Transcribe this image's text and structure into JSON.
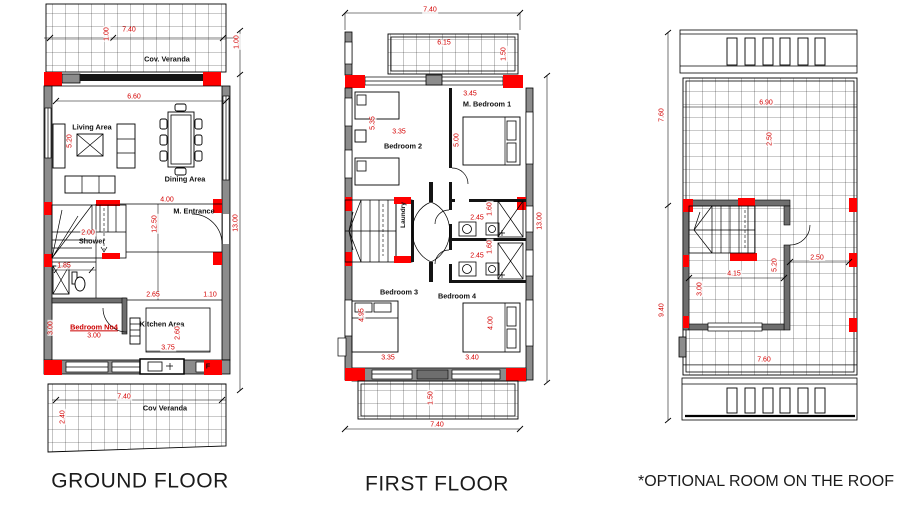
{
  "colors": {
    "wall_gray": "#8c8c8c",
    "column_red": "#ff0000",
    "dim_red": "#d40000",
    "line": "#000000"
  },
  "ground": {
    "title": "GROUND FLOOR",
    "labels": {
      "veranda_top": "Cov. Veranda",
      "veranda_bottom": "Cov Veranda",
      "living": "Living Area",
      "dining": "Dining Area",
      "entrance": "M. Entrance",
      "shower": "Shower",
      "bedroom4": "Bedroom No4",
      "kitchen": "Kitchen Area",
      "fridge": "F"
    },
    "dims": {
      "top_width": "7.40",
      "veranda_depth_a": "1.00",
      "veranda_depth_b": "1.00",
      "living_width": "6.60",
      "living_height": "5.20",
      "hall_width": "4.00",
      "inner_height": "12.50",
      "total_height": "13.00",
      "shower": "2.00",
      "wc": "1.85",
      "pass_a": "2.65",
      "pass_b": "1.10",
      "bed4_w": "3.00",
      "bed4_h": "3.00",
      "kitchen_w": "3.75",
      "kitchen_h": "2.60",
      "bottom_width": "7.40",
      "veranda_bottom_depth": "2.40"
    }
  },
  "first": {
    "title": "FIRST FLOOR",
    "labels": {
      "mbedroom1": "M. Bedroom 1",
      "bedroom2": "Bedroom 2",
      "bedroom3": "Bedroom 3",
      "bedroom4": "Bedroom 4",
      "laundry": "Laundry"
    },
    "dims": {
      "top_width": "7.40",
      "balcony_w": "6.15",
      "balcony_d": "1.50",
      "mbed1_w": "3.45",
      "mbed1_h": "5.00",
      "bed2_w": "3.35",
      "bed2_h": "5.35",
      "bath1_w": "2.45",
      "bath1_d": "1.60",
      "bath2_w": "2.45",
      "bath2_d": "1.60",
      "total_height": "13.00",
      "bed3_h": "4.95",
      "bed4_h": "4.00",
      "bed3_w": "3.35",
      "bed4_w": "3.40",
      "balcony_bottom_d": "1.50",
      "bottom_width": "7.40"
    }
  },
  "roof": {
    "title": "*OPTIONAL ROOM ON THE ROOF",
    "dims": {
      "upper_h": "7.60",
      "lower_h": "9.40",
      "terrace_w": "6.90",
      "terrace_d": "2.50",
      "room_w": "4.15",
      "room_h": "3.00",
      "room_side": "5.20",
      "side_w": "2.50",
      "bottom_w": "7.60"
    }
  }
}
